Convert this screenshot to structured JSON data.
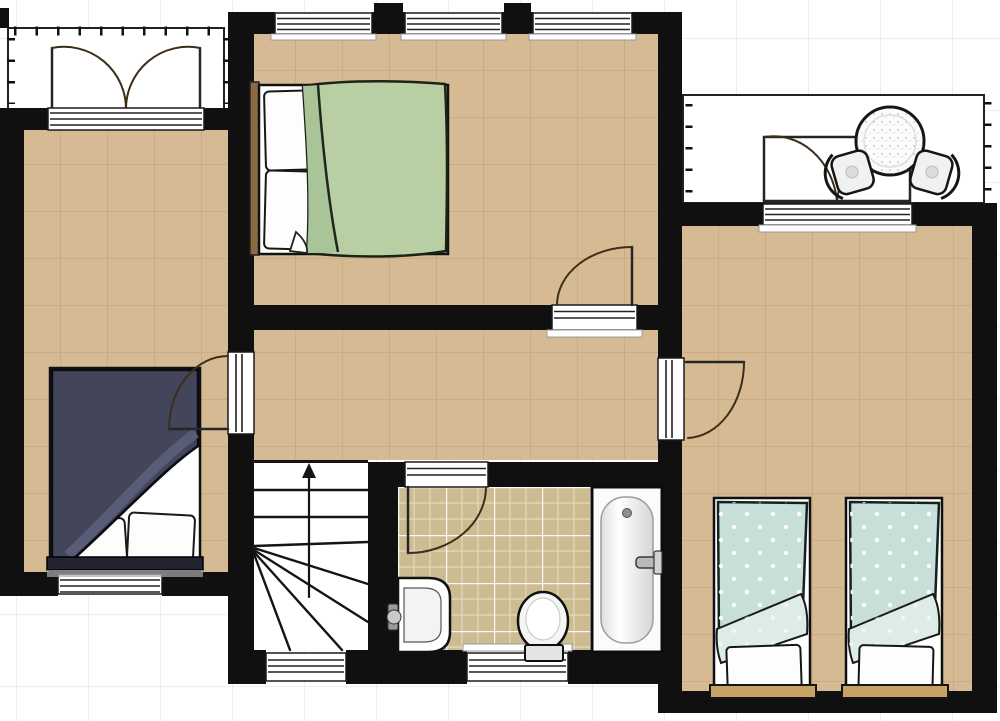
{
  "document": {
    "kind": "floor-plan",
    "orientation": "landscape"
  },
  "palette": {
    "outside_bg": "#ffffff",
    "outside_grid": "#e8e8e8",
    "wall": "#101010",
    "floor": "#d5ba93",
    "floor_grid": "#c3a37d",
    "tile": "#cdbb91",
    "line": "#1c1c1c",
    "door_arc": "#3d2e1a",
    "duvet_green": "#b7cfa2",
    "duvet_green_fold": "#a9c496",
    "duvet_navy": "#43455b",
    "duvet_navy_fold": "#5b5e78",
    "duvet_mint": "#c8dfd9",
    "duvet_mint_fold": "#deece7",
    "wood_dark": "#8a6b42",
    "wood_light": "#c8a264",
    "fixture_white": "#fbfbfb"
  },
  "plan": {
    "rooms": [
      {
        "name": "bedroom-top",
        "floor": "beige-grid",
        "furniture": [
          "double-bed-green-duvet"
        ],
        "openings": [
          "window-north-1",
          "window-north-2",
          "window-north-3",
          "door-to-hallway"
        ]
      },
      {
        "name": "bedroom-left",
        "floor": "beige-grid",
        "furniture": [
          "double-bed-navy-duvet"
        ],
        "openings": [
          "french-doors-to-balcony-north",
          "window-south",
          "door-to-hallway"
        ]
      },
      {
        "name": "bedroom-right",
        "floor": "beige-grid",
        "furniture": [
          "single-bed-mint-duvet",
          "single-bed-mint-duvet"
        ],
        "openings": [
          "french-doors-to-balcony-north",
          "door-to-hallway"
        ]
      },
      {
        "name": "hallway-landing",
        "floor": "beige-grid",
        "furniture": [],
        "openings": [
          "door-to-bedroom-top",
          "door-to-bedroom-left",
          "door-to-bedroom-right",
          "open-to-staircase",
          "door-to-bathroom"
        ]
      },
      {
        "name": "staircase",
        "floor": "white",
        "furniture": [
          "winder-stairs",
          "direction-up-arrow"
        ],
        "openings": [
          "window-south"
        ]
      },
      {
        "name": "bathroom",
        "floor": "tiled",
        "furniture": [
          "washbasin",
          "toilet",
          "bathtub"
        ],
        "openings": [
          "door-to-hallway",
          "window-south"
        ]
      },
      {
        "name": "balcony-top-left",
        "floor": "white",
        "furniture": [],
        "openings": [
          "french-double-doors"
        ],
        "railing": [
          "top-edge",
          "left-edge",
          "right-edge"
        ]
      },
      {
        "name": "balcony-top-right",
        "floor": "white",
        "furniture": [
          "round-table",
          "chair-left",
          "chair-right"
        ],
        "openings": [
          "french-double-doors"
        ],
        "railing": [
          "left-edge",
          "right-edge"
        ]
      }
    ]
  }
}
